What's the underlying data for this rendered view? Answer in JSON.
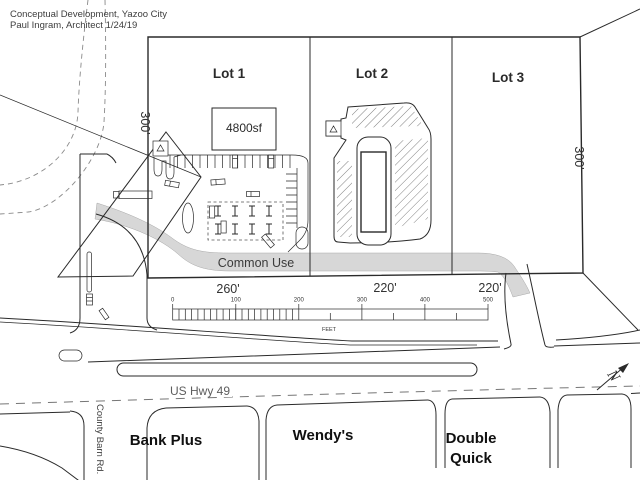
{
  "title": {
    "line1": "Conceptual Development, Yazoo City",
    "line2": "Paul Ingram, Architect  1/24/19"
  },
  "lots": {
    "lot1": "Lot 1",
    "lot2": "Lot 2",
    "lot3": "Lot 3"
  },
  "buildings": {
    "retail_sf": "4800sf"
  },
  "dimensions": {
    "lot1_frontage": "260'",
    "lot2_frontage": "220'",
    "lot3_frontage": "220'",
    "depth_west": "300'",
    "depth_east": "300'"
  },
  "common_area": {
    "label": "Common Use"
  },
  "scale_bar": {
    "ticks": [
      "0",
      "100",
      "200",
      "300",
      "400",
      "500"
    ],
    "unit": "FEET"
  },
  "roads": {
    "highway": "US Hwy 49",
    "side_street": "County Barn Rd."
  },
  "neighbors": {
    "bank": "Bank Plus",
    "wendys": "Wendy's",
    "double_quick_line1": "Double",
    "double_quick_line2": "Quick"
  },
  "compass": {
    "north": "N"
  },
  "colors": {
    "ink": "#2a2a2a",
    "shade": "#d7d7d7",
    "background": "#ffffff"
  }
}
